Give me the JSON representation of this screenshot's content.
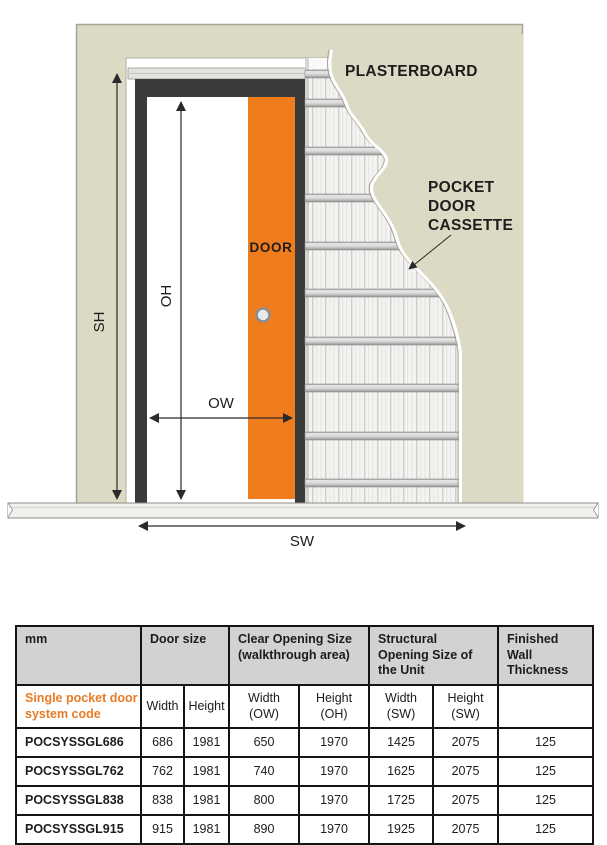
{
  "diagram": {
    "labels": {
      "plasterboard": "PLASTERBOARD",
      "pocket_door_cassette": [
        "POCKET",
        "DOOR",
        "CASSETTE"
      ],
      "door": "DOOR"
    },
    "dimensions": {
      "sh": "SH",
      "oh": "OH",
      "ow": "OW",
      "sw": "SW"
    },
    "colors": {
      "door_orange": "#ef7c1d",
      "wall_beige": "#dcd9c4",
      "frame_dark": "#3b3b3b"
    }
  },
  "table": {
    "groups": [
      "mm",
      "Door size",
      "Clear Opening Size (walkthrough area)",
      "Structural Opening Size of the Unit",
      "Finished Wall Thickness"
    ],
    "subheader": {
      "code_label_l1": "Single pocket door",
      "code_label_l2": "system code",
      "cols": [
        {
          "l1": "Width",
          "l2": ""
        },
        {
          "l1": "Height",
          "l2": ""
        },
        {
          "l1": "Width",
          "l2": "(OW)"
        },
        {
          "l1": "Height",
          "l2": "(OH)"
        },
        {
          "l1": "Width",
          "l2": "(SW)"
        },
        {
          "l1": "Height",
          "l2": "(SW)"
        }
      ]
    },
    "rows": [
      {
        "code": "POCSYSSGL686",
        "door_width": "686",
        "door_height": "1981",
        "clear_width": "650",
        "clear_height": "1970",
        "struct_width": "1425",
        "struct_height": "2075",
        "wall_thickness": "125"
      },
      {
        "code": "POCSYSSGL762",
        "door_width": "762",
        "door_height": "1981",
        "clear_width": "740",
        "clear_height": "1970",
        "struct_width": "1625",
        "struct_height": "2075",
        "wall_thickness": "125"
      },
      {
        "code": "POCSYSSGL838",
        "door_width": "838",
        "door_height": "1981",
        "clear_width": "800",
        "clear_height": "1970",
        "struct_width": "1725",
        "struct_height": "2075",
        "wall_thickness": "125"
      },
      {
        "code": "POCSYSSGL915",
        "door_width": "915",
        "door_height": "1981",
        "clear_width": "890",
        "clear_height": "1970",
        "struct_width": "1925",
        "struct_height": "2075",
        "wall_thickness": "125"
      }
    ]
  }
}
